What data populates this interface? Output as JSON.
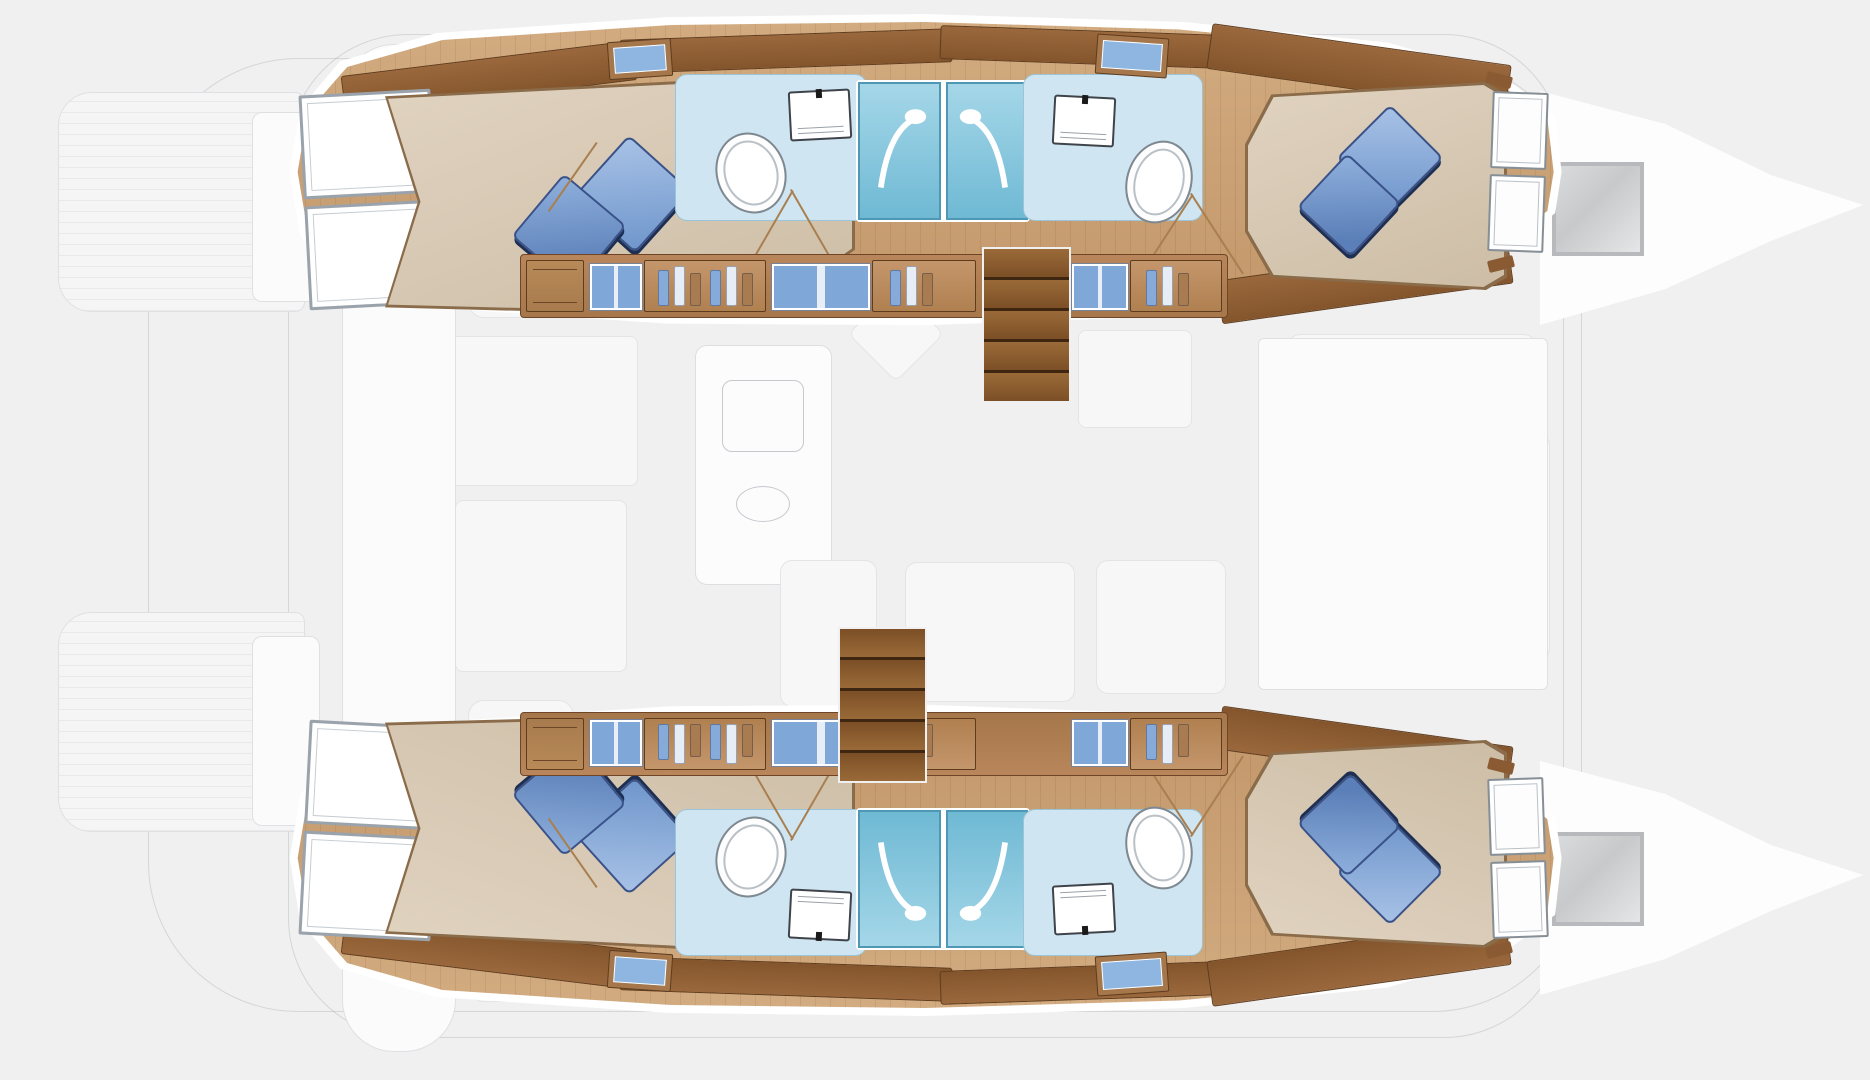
{
  "title": "Catamaran interior layout plan — 4 double cabins, 4 bathrooms, 2 shower stalls per hull",
  "diagram_type": "boat-floor-plan",
  "visible_text": [],
  "palette": {
    "background": "#f0f0f1",
    "hull_floor_wood": "#c9a176",
    "dark_wood_trim": "#8a5a33",
    "locker_wood": "#b08050",
    "bed_fabric": "#d8c9b4",
    "pillow_blue": "#6f96cc",
    "pillow_shadow_navy": "#1d2f52",
    "bathroom_floor": "#cfe6f2",
    "shower_stall": "#7fc0da",
    "locker_door_blue": "#7fa8d8",
    "stairs_wood": "#7c4f26",
    "faint_deck_outline": "#dfe0e3",
    "deck_hatch_gray": "#c7c9cb",
    "hull_border_white": "#ffffff"
  },
  "hulls": [
    {
      "id": "port-hull",
      "position": "top",
      "rooms": [
        "aft-double-cabin",
        "aft-bathroom",
        "two-central-shower-stalls",
        "forward-bathroom",
        "forward-double-cabin"
      ],
      "features": [
        "wardrobe-doors",
        "double-bed-2-pillows",
        "oval-sink",
        "toilet",
        "hanging-lockers",
        "companionway-stairs",
        "bow-windows"
      ]
    },
    {
      "id": "starboard-hull",
      "position": "bottom",
      "rooms": [
        "aft-double-cabin",
        "aft-bathroom",
        "two-central-shower-stalls",
        "forward-bathroom",
        "forward-double-cabin"
      ],
      "features": [
        "wardrobe-doors",
        "double-bed-2-pillows",
        "oval-sink",
        "toilet",
        "hanging-lockers",
        "companionway-stairs",
        "bow-windows"
      ]
    }
  ],
  "deck_faint_elements": [
    "stern-swim-platforms",
    "transom-steps",
    "center-walkway",
    "cockpit-benches",
    "saloon-galley-island",
    "galley-sink",
    "nav-seat",
    "saloon-sofa",
    "saloon-table",
    "forward-cockpit",
    "bow-deck-hatches",
    "bow-outlines"
  ],
  "icon_legend": {
    "sink-icon": "nested white ovals",
    "toilet-icon": "white square with black button",
    "shower-icon": "white hose arc with shower head",
    "hanging-clothes-icon": "three vertical bars (blue/white/brown)",
    "stairs-icon": "stacked brown treads",
    "pillow-icon": "rotated blue square with navy shadow"
  }
}
